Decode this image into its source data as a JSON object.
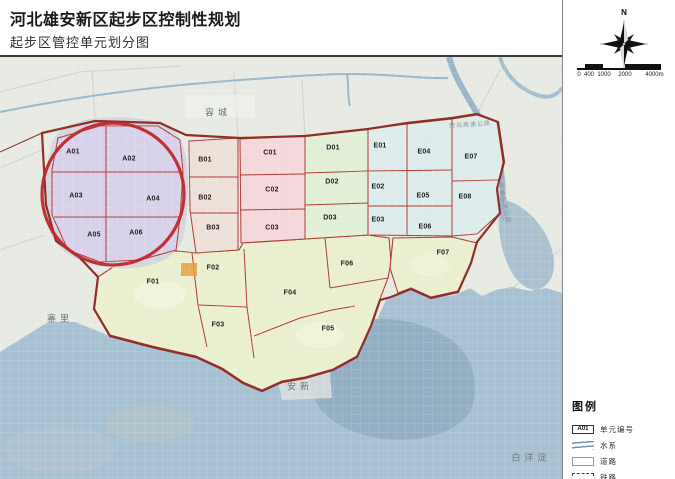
{
  "header": {
    "title": "河北雄安新区起步区控制性规划",
    "subtitle": "起步区管控单元划分图"
  },
  "map": {
    "unit_labels": [
      {
        "text": "A01",
        "x": 73,
        "y": 152
      },
      {
        "text": "A02",
        "x": 129,
        "y": 159
      },
      {
        "text": "A03",
        "x": 76,
        "y": 196
      },
      {
        "text": "A04",
        "x": 153,
        "y": 199
      },
      {
        "text": "A05",
        "x": 94,
        "y": 235
      },
      {
        "text": "A06",
        "x": 136,
        "y": 233
      },
      {
        "text": "B01",
        "x": 205,
        "y": 160
      },
      {
        "text": "B02",
        "x": 205,
        "y": 198
      },
      {
        "text": "B03",
        "x": 213,
        "y": 228
      },
      {
        "text": "C01",
        "x": 270,
        "y": 153
      },
      {
        "text": "C02",
        "x": 272,
        "y": 190
      },
      {
        "text": "C03",
        "x": 272,
        "y": 228
      },
      {
        "text": "D01",
        "x": 333,
        "y": 148
      },
      {
        "text": "D02",
        "x": 332,
        "y": 182
      },
      {
        "text": "D03",
        "x": 330,
        "y": 218
      },
      {
        "text": "E01",
        "x": 380,
        "y": 146
      },
      {
        "text": "E02",
        "x": 378,
        "y": 187
      },
      {
        "text": "E03",
        "x": 378,
        "y": 220
      },
      {
        "text": "E04",
        "x": 424,
        "y": 152
      },
      {
        "text": "E05",
        "x": 423,
        "y": 196
      },
      {
        "text": "E06",
        "x": 425,
        "y": 227
      },
      {
        "text": "E07",
        "x": 471,
        "y": 157
      },
      {
        "text": "E08",
        "x": 465,
        "y": 197
      },
      {
        "text": "F01",
        "x": 153,
        "y": 282
      },
      {
        "text": "F02",
        "x": 213,
        "y": 268
      },
      {
        "text": "F03",
        "x": 218,
        "y": 325
      },
      {
        "text": "F04",
        "x": 290,
        "y": 293
      },
      {
        "text": "F05",
        "x": 328,
        "y": 329
      },
      {
        "text": "F06",
        "x": 347,
        "y": 264
      },
      {
        "text": "F07",
        "x": 443,
        "y": 253
      }
    ],
    "place_labels": [
      {
        "text": "容城",
        "x": 218,
        "y": 112
      },
      {
        "text": "寨里",
        "x": 60,
        "y": 318
      },
      {
        "text": "安新",
        "x": 300,
        "y": 386
      },
      {
        "text": "白洋淀",
        "x": 531,
        "y": 457
      }
    ],
    "road_labels": [
      {
        "text": "荣乌高速公路",
        "x": 470,
        "y": 124,
        "rotate": -4
      },
      {
        "text": "京雄高速公路",
        "x": 505,
        "y": 203,
        "rotate": 78
      }
    ]
  },
  "sidebar": {
    "compass_label": "N",
    "scalebar": {
      "ticks": [
        {
          "text": "0",
          "x": 2
        },
        {
          "text": "400",
          "x": 12
        },
        {
          "text": "1000",
          "x": 27
        },
        {
          "text": "2000",
          "x": 48
        },
        {
          "text": "4000m",
          "x": 82
        }
      ]
    },
    "legend": {
      "title": "图例",
      "items": [
        {
          "type": "unit-box",
          "symbol_text": "A01",
          "label": "单元编号"
        },
        {
          "type": "water",
          "label": "水系"
        },
        {
          "type": "road",
          "label": "道路"
        },
        {
          "type": "railway",
          "label": "铁路"
        }
      ]
    }
  },
  "colors": {
    "region_a": "#d7d2e9",
    "region_b": "#ece0d8",
    "region_c": "#f3d7da",
    "region_d": "#e2efd7",
    "region_e": "#ddeceb",
    "region_f": "#e9efcf",
    "unit_line": "#b03a33",
    "outer_boundary": "#8f2f28",
    "circle": "#c1272d",
    "water": "#a7c0d2",
    "background": "#e7eae3"
  }
}
